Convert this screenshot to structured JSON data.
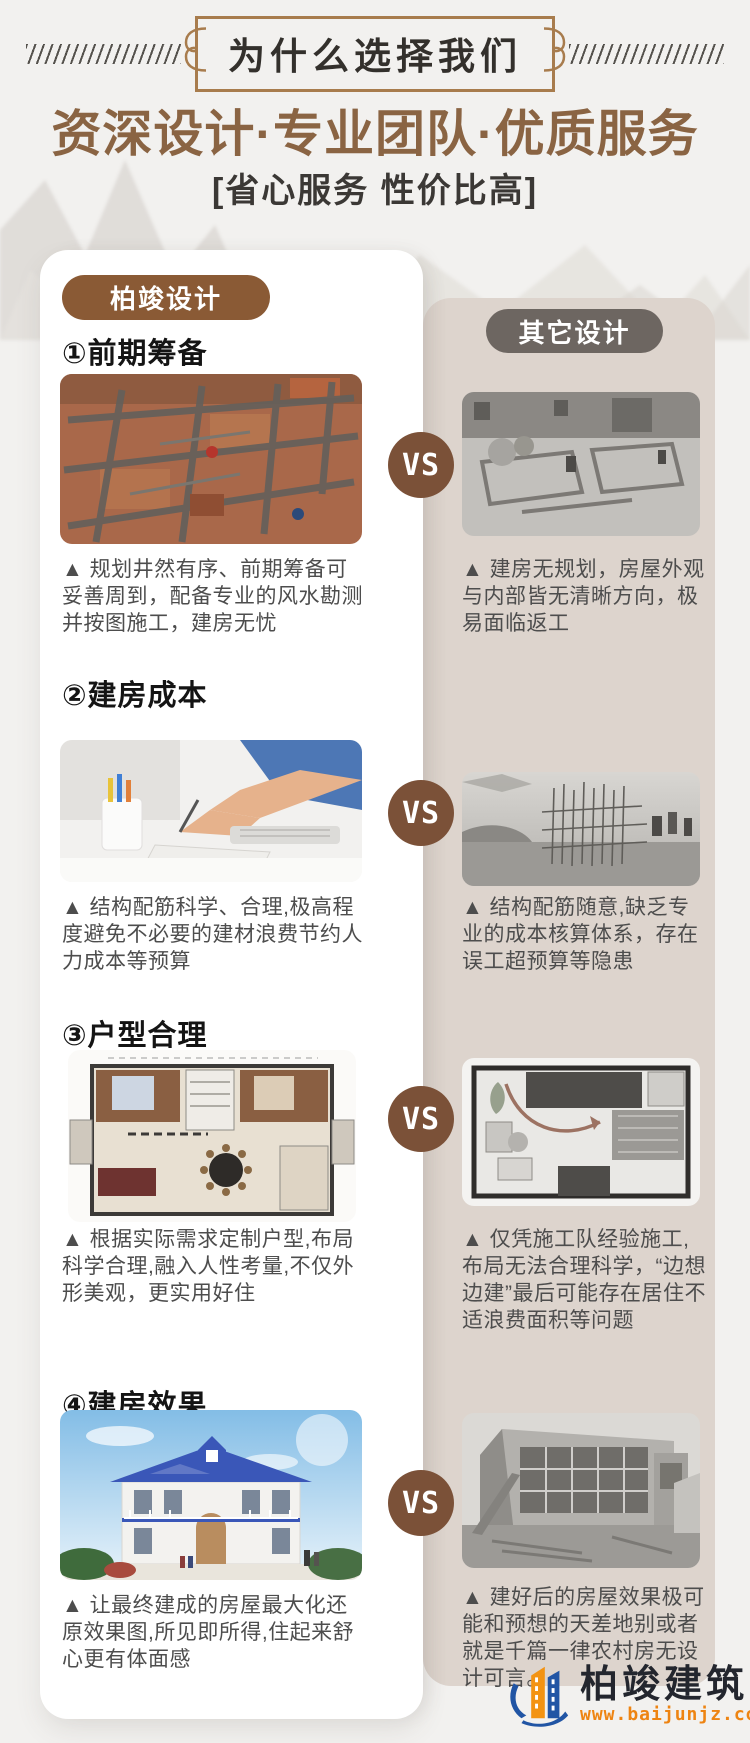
{
  "header": {
    "badge_title": "为什么选择我们",
    "main_title": "资深设计·专业团队·优质服务",
    "subtitle": "[省心服务  性价比高]"
  },
  "comparison": {
    "brand_label": "柏竣设计",
    "other_label": "其它设计",
    "vs_label": "VS",
    "sections": [
      {
        "heading": "①前期筹备",
        "left_image": "planned-foundation-construction-photo",
        "right_image": "unplanned-foundation-grayscale-photo",
        "left_caption": "▲ 规划井然有序、前期筹备可妥善周到，配备专业的风水勘测并按图施工，建房无忧",
        "right_caption": "▲ 建房无规划，房屋外观与内部皆无清晰方向，极易面临返工"
      },
      {
        "heading": "②建房成本",
        "left_image": "designer-budgeting-at-desk-photo",
        "right_image": "random-rebar-site-grayscale-photo",
        "left_caption": "▲ 结构配筋科学、合理,极高程度避免不必要的建材浪费节约人力成本等预算",
        "right_caption": "▲ 结构配筋随意,缺乏专业的成本核算体系，存在误工超预算等隐患"
      },
      {
        "heading": "③户型合理",
        "left_image": "custom-floor-plan-color-photo",
        "right_image": "improvised-floor-plan-grayscale-photo",
        "left_caption": "▲ 根据实际需求定制户型,布局科学合理,融入人性考量,不仅外形美观，更实用好住",
        "right_caption": "▲ 仅凭施工队经验施工,布局无法合理科学，“边想边建”最后可能存在居住不适浪费面积等问题"
      },
      {
        "heading": "④建房效果",
        "left_image": "finished-villa-blue-roof-photo",
        "right_image": "plain-rural-house-grayscale-photo",
        "left_caption": "▲ 让最终建成的房屋最大化还原效果图,所见即所得,住起来舒心更有体面感",
        "right_caption": "▲ 建好后的房屋效果极可能和预想的天差地别或者就是千篇一律农村房无设计可言。"
      }
    ]
  },
  "footer": {
    "brand_name": "柏竣建筑",
    "brand_url": "www.baijunjz.com",
    "logo_icon": "building-swoosh-logo-icon"
  },
  "colors": {
    "page_bg": "#f2f1ef",
    "brand_brown": "#8a5a35",
    "title_brown": "#8a6443",
    "vs_brown": "#7b5138",
    "beige_card": "#ddd4cd",
    "other_gray": "#6d6661",
    "logo_blue": "#2155a4",
    "logo_orange": "#f39312"
  }
}
